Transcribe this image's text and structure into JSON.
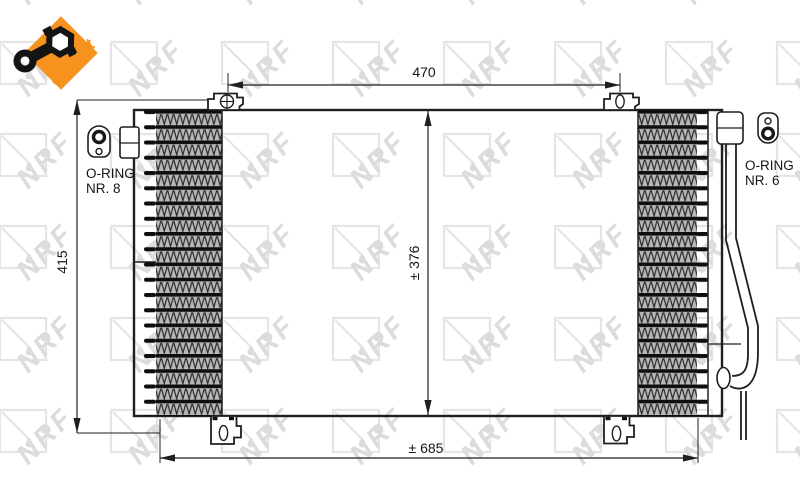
{
  "colors": {
    "accent_orange": "#f6921e",
    "line": "#1f1f1f",
    "watermark_gray": "#e5e5e5",
    "watermark_text_gray": "#dcdcdc"
  },
  "logo": {
    "badge_text": "easyfit"
  },
  "watermark": {
    "text": "NRF"
  },
  "drawing": {
    "dimensions": {
      "top_width": "470",
      "overall_height": "415",
      "core_height": "± 376",
      "overall_width": "± 685"
    },
    "fittings": {
      "left_line1": "O-RING",
      "left_line2": "NR. 8",
      "right_line1": "O-RING",
      "right_line2": "NR. 6"
    }
  }
}
